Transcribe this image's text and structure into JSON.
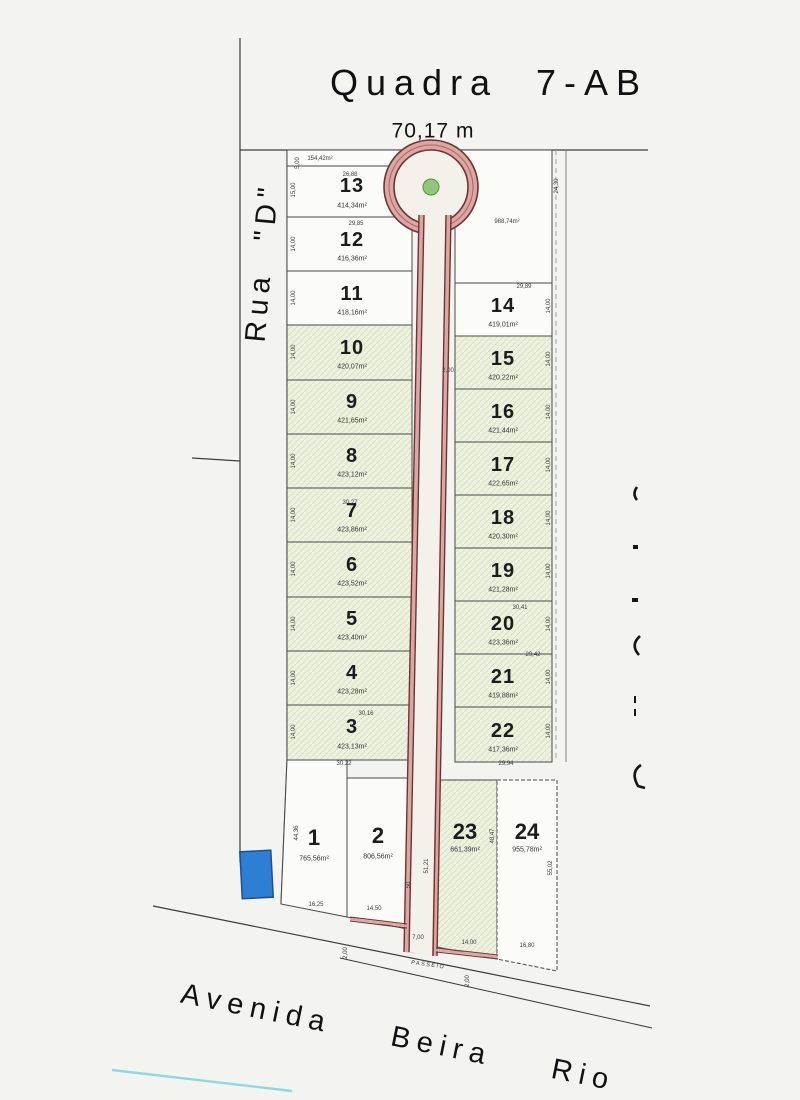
{
  "title": {
    "quadra": "Quadra",
    "code": "7-AB"
  },
  "dimensions": {
    "top_width": "70,17 m"
  },
  "streets": {
    "rua_d": "Rua \"D\"",
    "avenida": "Avenida Beira Rio",
    "passeio": "PASSEIO"
  },
  "lots": {
    "l1": {
      "num": "1",
      "area": "765,56m²"
    },
    "l2": {
      "num": "2",
      "area": "806,56m²"
    },
    "l3": {
      "num": "3",
      "area": "423,13m²"
    },
    "l4": {
      "num": "4",
      "area": "423,28m²"
    },
    "l5": {
      "num": "5",
      "area": "423,40m²"
    },
    "l6": {
      "num": "6",
      "area": "423,52m²"
    },
    "l7": {
      "num": "7",
      "area": "423,86m²"
    },
    "l8": {
      "num": "8",
      "area": "423,12m²"
    },
    "l9": {
      "num": "9",
      "area": "421,65m²"
    },
    "l10": {
      "num": "10",
      "area": "420,07m²"
    },
    "l11": {
      "num": "11",
      "area": "418,16m²"
    },
    "l12": {
      "num": "12",
      "area": "416,36m²"
    },
    "l13": {
      "num": "13",
      "area": "414,34m²"
    },
    "l14": {
      "num": "14",
      "area": "419,01m²"
    },
    "l15": {
      "num": "15",
      "area": "420,22m²"
    },
    "l16": {
      "num": "16",
      "area": "421,44m²"
    },
    "l17": {
      "num": "17",
      "area": "422,65m²"
    },
    "l18": {
      "num": "18",
      "area": "420,30m²"
    },
    "l19": {
      "num": "19",
      "area": "421,28m²"
    },
    "l20": {
      "num": "20",
      "area": "423,36m²"
    },
    "l21": {
      "num": "21",
      "area": "419,88m²"
    },
    "l22": {
      "num": "22",
      "area": "417,36m²"
    },
    "l23": {
      "num": "23",
      "area": "661,39m²"
    },
    "l24": {
      "num": "24",
      "area": "955,78m²"
    }
  },
  "m": {
    "w1500": "15,00",
    "w1400": "14,00",
    "t2688": "26,88",
    "s15442": "154,42m²",
    "v500": "5,00",
    "t2985": "29,85",
    "t3027": "30,27",
    "t3016": "30,16",
    "t3022": "30,22",
    "b1625": "16,25",
    "b1450": "14,50",
    "v4436": "44,36",
    "v50": "50",
    "v5121": "51,21",
    "w700": "7,00",
    "w200": "2,00",
    "b1680": "16,80",
    "v4847": "48,47",
    "v5502": "55,02",
    "a98874": "988,74m²",
    "v2430": "24,30",
    "t2989": "29,89",
    "t3041": "30,41",
    "t2942": "29,42",
    "t2994": "29,94"
  },
  "colors": {
    "road_line": "#6e3434",
    "road_fill": "#dba7a2",
    "road_center": "#f4f1ea",
    "green_dot": "#93c67c",
    "blue_marker": "#2c7fd3",
    "cyan_line": "#8ed8e6",
    "lot_green": "#edf2df",
    "lot_hatch_line": "#cdd9b8",
    "lot_white": "#fbfbf7",
    "boundary": "#3c3c3c"
  }
}
